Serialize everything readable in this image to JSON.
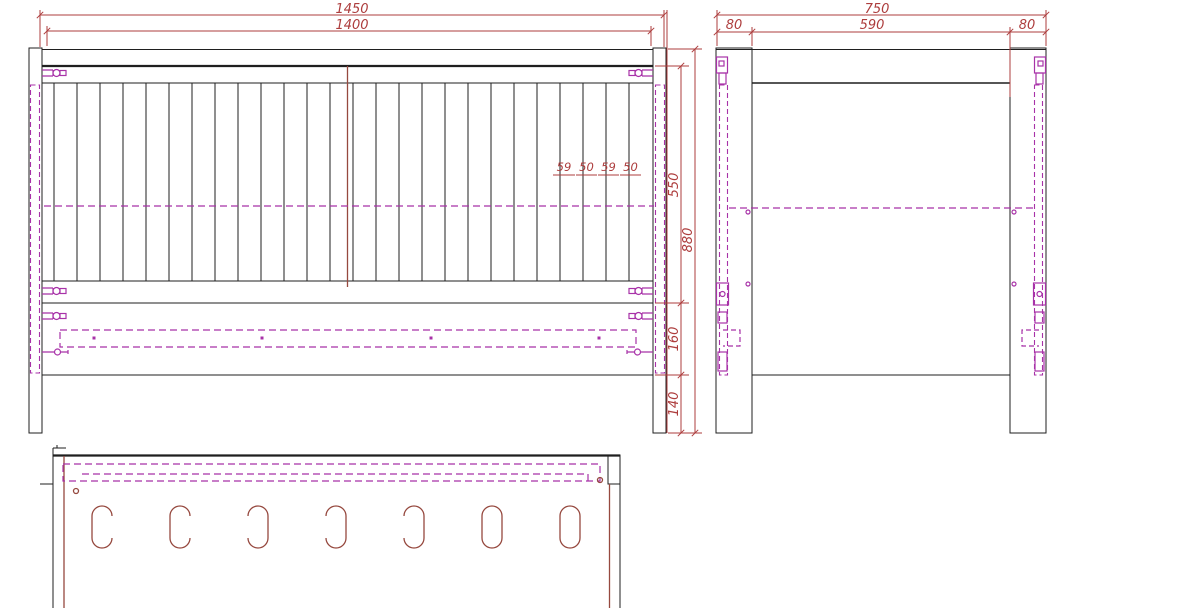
{
  "front_view": {
    "dim_width_overall": "1450",
    "dim_width_inner": "1400",
    "slat_dim_1": "59",
    "slat_dim_2": "50",
    "slat_dim_3": "59",
    "slat_dim_4": "50",
    "dim_height_panel": "550",
    "dim_height_overall": "880",
    "dim_height_base_rail": "160",
    "dim_height_leg": "140",
    "slat_line_count": 26,
    "support_dot_count": 4
  },
  "side_view": {
    "dim_depth_overall": "750",
    "dim_post_front": "80",
    "dim_depth_inner": "590",
    "dim_post_back": "80"
  },
  "bottom_view": {
    "slot_count": 7,
    "slot_styles": [
      "open-right",
      "open-right",
      "open-left",
      "open-left",
      "open-left",
      "closed",
      "closed"
    ]
  },
  "colors": {
    "outline": "#1f1f1f",
    "dimension": "#ad3d3d",
    "hidden": "#a832a8",
    "detail": "#96493f"
  }
}
